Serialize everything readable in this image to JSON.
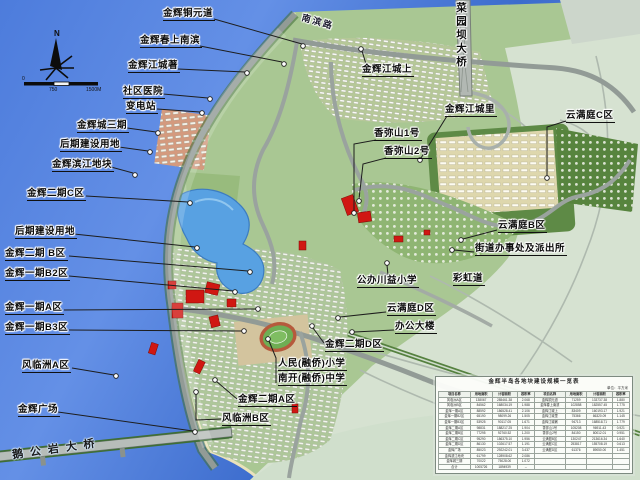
{
  "map": {
    "compass": {
      "north_label": "N"
    },
    "scale_bar": {
      "ticks": [
        "0",
        "750",
        "1500M"
      ]
    },
    "labels": [
      {
        "id": "jinhui-tongyuandao",
        "text": "金辉铜元道",
        "x": 163,
        "y": 8,
        "style": "callout",
        "leader": [
          [
            214,
            19
          ],
          [
            302,
            44
          ]
        ],
        "dot": [
          303,
          46
        ]
      },
      {
        "id": "nanbin-road",
        "text": "南滨路",
        "x": 301,
        "y": 17,
        "style": "road",
        "rot": 16
      },
      {
        "id": "caiyuanba-bridge",
        "text": "菜园坝大桥",
        "x": 455,
        "y": 2,
        "style": "bridge-v"
      },
      {
        "id": "jinhui-chunshang-nanbin",
        "text": "金辉春上南滨",
        "x": 140,
        "y": 35,
        "style": "callout",
        "leader": [
          [
            200,
            46
          ],
          [
            282,
            62
          ]
        ],
        "dot": [
          284,
          64
        ]
      },
      {
        "id": "jinhui-jiangcheng-zhu",
        "text": "金辉江城著",
        "x": 128,
        "y": 60,
        "style": "callout",
        "leader": [
          [
            178,
            69
          ],
          [
            245,
            72
          ]
        ],
        "dot": [
          247,
          73
        ]
      },
      {
        "id": "shequ-yiyuan",
        "text": "社区医院",
        "x": 123,
        "y": 86,
        "style": "callout",
        "leader": [
          [
            163,
            94
          ],
          [
            208,
            98
          ]
        ],
        "dot": [
          210,
          99
        ]
      },
      {
        "id": "biandianzhan",
        "text": "变电站",
        "x": 126,
        "y": 101,
        "style": "callout",
        "leader": [
          [
            157,
            109
          ],
          [
            200,
            112
          ]
        ],
        "dot": [
          202,
          113
        ]
      },
      {
        "id": "jinhuicheng-sanqi",
        "text": "金辉城三期",
        "x": 77,
        "y": 120,
        "style": "callout",
        "leader": [
          [
            127,
            128
          ],
          [
            156,
            132
          ]
        ],
        "dot": [
          158,
          133
        ]
      },
      {
        "id": "houqi-jianshe-1",
        "text": "后期建设用地",
        "x": 60,
        "y": 139,
        "style": "callout",
        "leader": [
          [
            119,
            147
          ],
          [
            148,
            151
          ]
        ],
        "dot": [
          150,
          152
        ]
      },
      {
        "id": "jinhui-binjiang-dikuai",
        "text": "金辉滨江地块",
        "x": 52,
        "y": 159,
        "style": "callout",
        "leader": [
          [
            111,
            167
          ],
          [
            133,
            173
          ]
        ],
        "dot": [
          135,
          175
        ]
      },
      {
        "id": "jinhui-erqi-c",
        "text": "金辉二期C区",
        "x": 27,
        "y": 188,
        "style": "callout",
        "leader": [
          [
            86,
            196
          ],
          [
            188,
            202
          ]
        ],
        "dot": [
          190,
          203
        ]
      },
      {
        "id": "houqi-jianshe-2",
        "text": "后期建设用地",
        "x": 15,
        "y": 226,
        "style": "callout",
        "leader": [
          [
            74,
            234
          ],
          [
            195,
            247
          ]
        ],
        "dot": [
          197,
          248
        ]
      },
      {
        "id": "jinhui-erqi-b",
        "text": "金辉二期 B区",
        "x": 5,
        "y": 248,
        "style": "callout",
        "leader": [
          [
            69,
            256
          ],
          [
            248,
            271
          ]
        ],
        "dot": [
          250,
          272
        ]
      },
      {
        "id": "jinhui-yiqi-b2",
        "text": "金辉一期B2区",
        "x": 5,
        "y": 268,
        "style": "callout",
        "leader": [
          [
            69,
            276
          ],
          [
            233,
            291
          ]
        ],
        "dot": [
          235,
          292
        ]
      },
      {
        "id": "jinhui-yiqi-a",
        "text": "金辉一期A区",
        "x": 5,
        "y": 302,
        "style": "callout",
        "leader": [
          [
            64,
            310
          ],
          [
            256,
            309
          ]
        ],
        "dot": [
          258,
          309
        ]
      },
      {
        "id": "jinhui-yiqi-b3",
        "text": "金辉一期B3区",
        "x": 5,
        "y": 322,
        "style": "callout",
        "leader": [
          [
            69,
            330
          ],
          [
            242,
            331
          ]
        ],
        "dot": [
          244,
          331
        ]
      },
      {
        "id": "fenglinzhou-a",
        "text": "风临洲A区",
        "x": 22,
        "y": 360,
        "style": "callout",
        "leader": [
          [
            72,
            368
          ],
          [
            114,
            375
          ]
        ],
        "dot": [
          116,
          376
        ]
      },
      {
        "id": "jinhui-guangchang",
        "text": "金辉广场",
        "x": 18,
        "y": 404,
        "style": "callout",
        "leader": [
          [
            58,
            412
          ],
          [
            193,
            431
          ]
        ],
        "dot": [
          195,
          432
        ]
      },
      {
        "id": "jinhui-jiangcheng-shang",
        "text": "金辉江城上",
        "x": 362,
        "y": 64,
        "style": "callout",
        "leader": [
          [
            366,
            64
          ],
          [
            362,
            51
          ]
        ],
        "dot": [
          361,
          49
        ]
      },
      {
        "id": "jinhui-jiangcheng-li",
        "text": "金辉江城里",
        "x": 445,
        "y": 104,
        "style": "callout",
        "leader": [
          [
            447,
            116
          ],
          [
            421,
            158
          ]
        ],
        "dot": [
          420,
          160
        ]
      },
      {
        "id": "yunmanting-c",
        "text": "云满庭C区",
        "x": 566,
        "y": 110,
        "style": "callout",
        "leader": [
          [
            566,
            121
          ],
          [
            547,
            127
          ],
          [
            547,
            176
          ]
        ],
        "dot": [
          547,
          178
        ]
      },
      {
        "id": "xiangmishan-1",
        "text": "香弥山1号",
        "x": 374,
        "y": 128,
        "style": "callout",
        "leader": [
          [
            376,
            140
          ],
          [
            354,
            144
          ],
          [
            354,
            211
          ]
        ],
        "dot": [
          354,
          213
        ]
      },
      {
        "id": "xiangmishan-2",
        "text": "香弥山2号",
        "x": 384,
        "y": 146,
        "style": "callout",
        "leader": [
          [
            386,
            158
          ],
          [
            363,
            164
          ],
          [
            359,
            199
          ]
        ],
        "dot": [
          359,
          201
        ]
      },
      {
        "id": "yunmanting-b",
        "text": "云满庭B区",
        "x": 498,
        "y": 220,
        "style": "callout",
        "leader": [
          [
            497,
            230
          ],
          [
            463,
            239
          ]
        ],
        "dot": [
          461,
          240
        ]
      },
      {
        "id": "jiedao-banshichu",
        "text": "街道办事处及派出所",
        "x": 475,
        "y": 243,
        "style": "callout",
        "leader": [
          [
            474,
            252
          ],
          [
            454,
            250
          ]
        ],
        "dot": [
          452,
          250
        ]
      },
      {
        "id": "gongban-chuanyi-xiaoxue",
        "text": "公办川益小学",
        "x": 357,
        "y": 275,
        "style": "callout",
        "leader": [
          [
            388,
            275
          ],
          [
            387,
            265
          ]
        ],
        "dot": [
          387,
          263
        ]
      },
      {
        "id": "caihong-dao",
        "text": "彩虹道",
        "x": 453,
        "y": 273,
        "style": "callout"
      },
      {
        "id": "yunmanting-d",
        "text": "云满庭D区",
        "x": 387,
        "y": 303,
        "style": "callout",
        "leader": [
          [
            386,
            312
          ],
          [
            340,
            317
          ]
        ],
        "dot": [
          338,
          318
        ]
      },
      {
        "id": "bangong-dalou",
        "text": "办公大楼",
        "x": 395,
        "y": 321,
        "style": "callout",
        "leader": [
          [
            394,
            330
          ],
          [
            354,
            332
          ]
        ],
        "dot": [
          352,
          332
        ]
      },
      {
        "id": "jinhui-erqi-d",
        "text": "金辉二期D区",
        "x": 325,
        "y": 339,
        "style": "callout",
        "leader": [
          [
            324,
            343
          ],
          [
            313,
            328
          ]
        ],
        "dot": [
          312,
          326
        ]
      },
      {
        "id": "renmin-rongqiao-xiaoxue",
        "text": "人民(融侨)小学",
        "x": 278,
        "y": 358,
        "style": "callout",
        "leader": [
          [
            276,
            383
          ],
          [
            276,
            358
          ],
          [
            269,
            341
          ]
        ],
        "dot": [
          268,
          339
        ]
      },
      {
        "id": "nankai-rongqiao-zhongxue",
        "text": "南开(融侨)中学",
        "x": 278,
        "y": 373,
        "style": "callout"
      },
      {
        "id": "jinhui-erqi-a",
        "text": "金辉二期A区",
        "x": 238,
        "y": 394,
        "style": "callout",
        "leader": [
          [
            237,
            399
          ],
          [
            216,
            381
          ]
        ],
        "dot": [
          215,
          380
        ]
      },
      {
        "id": "fenglinzhou-b",
        "text": "风临洲B区",
        "x": 222,
        "y": 413,
        "style": "callout",
        "leader": [
          [
            221,
            419
          ],
          [
            196,
            420
          ],
          [
            196,
            394
          ]
        ],
        "dot": [
          196,
          392
        ]
      },
      {
        "id": "egongyan-bridge",
        "text": "鹅公岩大桥",
        "x": 12,
        "y": 444,
        "style": "bridge-d",
        "rot": -8
      }
    ]
  },
  "table": {
    "title": "金辉半岛各地块建设规模一览表",
    "unit_note": "单位：平方米",
    "headers": [
      "项目名称",
      "用地面积",
      "计容面积",
      "容积率"
    ],
    "left_rows": [
      [
        "风临洲A区",
        "138067",
        "285461.38",
        "2.068"
      ],
      [
        "风临洲B区",
        "84562",
        "168034.19",
        "1.988"
      ],
      [
        "金辉一期A区",
        "88592",
        "186528.41",
        "2.106"
      ],
      [
        "金辉一期B2区",
        "65190",
        "98099.26",
        "1.505"
      ],
      [
        "金辉一期B3区",
        "53925",
        "90117.05",
        "1.671"
      ],
      [
        "金辉二期A区",
        "98831",
        "188217.25",
        "1.904"
      ],
      [
        "金辉二期B区",
        "77295",
        "92760.52",
        "1.200"
      ],
      [
        "金辉二期C区",
        "95290",
        "186375.10",
        "1.956"
      ],
      [
        "金辉二期D区",
        "86130",
        "102617.57",
        "1.191"
      ],
      [
        "金辉广场",
        "85023",
        "292242.01",
        "3.437"
      ],
      [
        "金辉滨江地块",
        "61799",
        "128908.62",
        "2.086"
      ],
      [
        "金辉城三期",
        "70022",
        "75028.00",
        "1.072"
      ],
      [
        "合计",
        "1005726",
        "1894939",
        "--"
      ]
    ],
    "right_rows": [
      [
        "金辉铜元道",
        "71259",
        "133737.38",
        "1.880"
      ],
      [
        "金辉春上南滨",
        "102858",
        "182557.45",
        "1.775"
      ],
      [
        "金辉江城上",
        "83409",
        "160193.17",
        "1.921"
      ],
      [
        "金辉江城里",
        "75366",
        "86320.09",
        "1.145"
      ],
      [
        "金辉江城著",
        "94713",
        "168518.71",
        "1.779"
      ],
      [
        "香弥山1号",
        "105208",
        "96911.43",
        "0.921"
      ],
      [
        "香弥山2号",
        "84150",
        "80012.01",
        "0.951"
      ],
      [
        "云满庭B区",
        "130247",
        "213616.34",
        "1.640"
      ],
      [
        "云满庭C区",
        "253817",
        "155708.19",
        "0.613"
      ],
      [
        "云满庭D区",
        "61376",
        "89050.00",
        "1.451"
      ]
    ]
  }
}
